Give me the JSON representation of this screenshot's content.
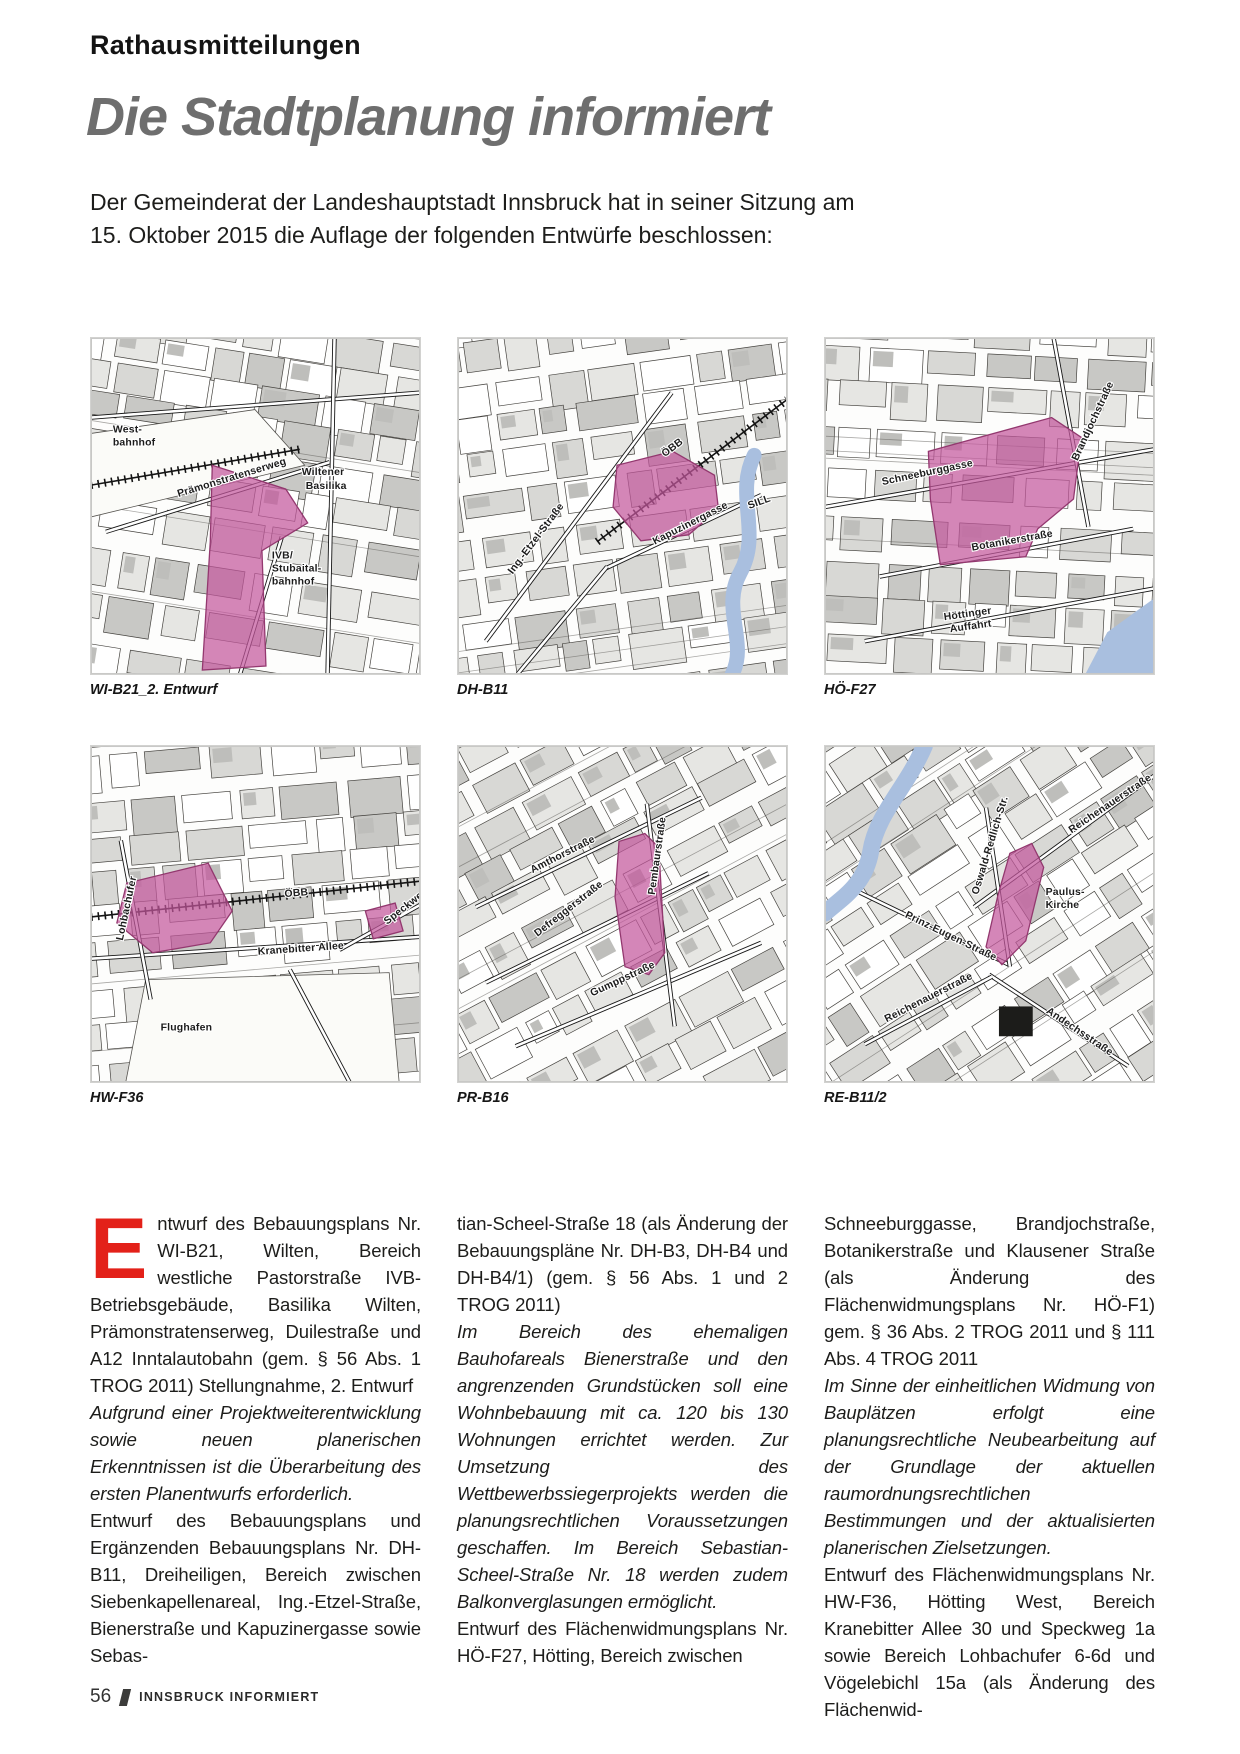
{
  "header": {
    "kicker": "Rathausmitteilungen",
    "title": "Die Stadtplanung informiert",
    "intro": [
      "Der Gemeinderat der Landeshauptstadt Innsbruck hat in seiner Sitzung am",
      "15. Oktober 2015 die Auflage der folgenden Entwürfe beschlossen:"
    ]
  },
  "colors": {
    "accent_red": "#e32119",
    "title_gray": "#6e6e6e",
    "highlight_pink": "#c4589d",
    "highlight_stroke": "#93386f",
    "river_blue": "#a9bfdf",
    "building_grays": [
      "#ffffff",
      "#e6e6e3",
      "#d8d8d5",
      "#c8c8c5"
    ]
  },
  "maps": [
    {
      "caption": "WI-B21_2. Entwurf",
      "seed": 11,
      "grid_angle": 9,
      "roads": [
        [
          15,
          195,
          240,
          125
        ],
        [
          0,
          80,
          331,
          55
        ],
        [
          245,
          0,
          238,
          338
        ],
        [
          150,
          338,
          192,
          200
        ]
      ],
      "rails": [
        [
          0,
          148,
          210,
          112
        ]
      ],
      "open": [
        [
          "0,96 165,72 215,128 0,180"
        ]
      ],
      "river": null,
      "highlights": [
        "122,128 196,152 218,186 172,214 176,330 112,334 120,205"
      ],
      "darks": [],
      "labels": [
        {
          "t": "West-",
          "x": 22,
          "y": 95,
          "r": 0
        },
        {
          "t": "bahnhof",
          "x": 22,
          "y": 108,
          "r": 0
        },
        {
          "t": "Prämonstratenserweg",
          "x": 88,
          "y": 160,
          "r": -17
        },
        {
          "t": "Wiltener",
          "x": 212,
          "y": 138,
          "r": 0
        },
        {
          "t": "Basilika",
          "x": 216,
          "y": 152,
          "r": 0
        },
        {
          "t": "IVB/",
          "x": 182,
          "y": 222,
          "r": 0
        },
        {
          "t": "Stubaital-",
          "x": 182,
          "y": 235,
          "r": 0
        },
        {
          "t": "bahnhof",
          "x": 182,
          "y": 248,
          "r": 0
        }
      ]
    },
    {
      "caption": "DH-B11",
      "seed": 22,
      "grid_angle": -8,
      "roads": [
        [
          28,
          305,
          215,
          55
        ],
        [
          148,
          232,
          305,
          158
        ],
        [
          60,
          338,
          150,
          230
        ]
      ],
      "rails": [
        [
          140,
          205,
          331,
          62
        ]
      ],
      "open": [],
      "river": {
        "d": "M 298,118 C 278,158 306,196 284,236 C 264,272 292,306 276,338",
        "w": 15
      },
      "highlights": [
        "160,128 216,114 258,138 262,172 232,198 184,204 156,170"
      ],
      "darks": [],
      "labels": [
        {
          "t": "Ing.-Etzel-Straße",
          "x": 55,
          "y": 238,
          "r": -53
        },
        {
          "t": "ÖBB",
          "x": 208,
          "y": 120,
          "r": -37
        },
        {
          "t": "Kapuzinergasse",
          "x": 198,
          "y": 208,
          "r": -27
        },
        {
          "t": "SILL",
          "x": 293,
          "y": 172,
          "r": -20
        }
      ]
    },
    {
      "caption": "HÖ-F27",
      "seed": 33,
      "grid_angle": 3,
      "roads": [
        [
          0,
          170,
          331,
          112
        ],
        [
          55,
          240,
          310,
          192
        ],
        [
          40,
          305,
          331,
          252
        ],
        [
          230,
          0,
          265,
          190
        ]
      ],
      "rails": [],
      "open": [],
      "river": {
        "points": "284,296 331,262 331,338 262,338"
      },
      "highlights": [
        "104,114 228,80 258,100 250,162 214,192 202,220 116,228 106,162"
      ],
      "darks": [],
      "labels": [
        {
          "t": "Schneeburggasse",
          "x": 58,
          "y": 148,
          "r": -12
        },
        {
          "t": "Brandjochstraße",
          "x": 254,
          "y": 124,
          "r": -65
        },
        {
          "t": "Botanikerstraße",
          "x": 148,
          "y": 214,
          "r": -10
        },
        {
          "t": "Höttinger",
          "x": 120,
          "y": 284,
          "r": -8
        },
        {
          "t": "Auffahrt",
          "x": 126,
          "y": 296,
          "r": -8
        }
      ]
    },
    {
      "caption": "HW-F36",
      "seed": 44,
      "grid_angle": -5,
      "roads": [
        [
          0,
          214,
          331,
          192
        ],
        [
          30,
          95,
          60,
          255
        ],
        [
          250,
          205,
          331,
          160
        ],
        [
          200,
          225,
          260,
          338
        ]
      ],
      "rails": [
        [
          0,
          172,
          331,
          136
        ]
      ],
      "open": [
        [
          "55,235 300,228 310,338 35,338"
        ]
      ],
      "river": null,
      "highlights": [
        "36,138 118,118 142,166 120,198 62,208 26,178",
        "276,166 306,158 314,186 284,194"
      ],
      "darks": [],
      "labels": [
        {
          "t": "ÖBB",
          "x": 195,
          "y": 152,
          "r": -5
        },
        {
          "t": "Kranebitter Allee",
          "x": 168,
          "y": 210,
          "r": -4
        },
        {
          "t": "Flughafen",
          "x": 70,
          "y": 286,
          "r": 0
        },
        {
          "t": "Lohbachufer",
          "x": 32,
          "y": 196,
          "r": -78
        },
        {
          "t": "Speckweg",
          "x": 298,
          "y": 180,
          "r": -38
        }
      ]
    },
    {
      "caption": "PR-B16",
      "seed": 55,
      "grid_angle": -28,
      "roads": [
        [
          18,
          162,
          245,
          52
        ],
        [
          28,
          238,
          252,
          128
        ],
        [
          58,
          302,
          305,
          198
        ],
        [
          190,
          58,
          218,
          282
        ]
      ],
      "rails": [],
      "open": [],
      "river": null,
      "highlights": [
        "162,96 188,88 202,102 208,208 192,230 168,222 158,152"
      ],
      "darks": [],
      "labels": [
        {
          "t": "Amthorstraße",
          "x": 75,
          "y": 128,
          "r": -27
        },
        {
          "t": "Defreggerstraße",
          "x": 80,
          "y": 192,
          "r": -38
        },
        {
          "t": "Gumppstraße",
          "x": 135,
          "y": 252,
          "r": -25
        },
        {
          "t": "Pembaurstraße",
          "x": 198,
          "y": 150,
          "r": -82
        }
      ]
    },
    {
      "caption": "RE-B11/2",
      "seed": 66,
      "grid_angle": -33,
      "roads": [
        [
          150,
          162,
          331,
          30
        ],
        [
          30,
          145,
          185,
          220
        ],
        [
          165,
          230,
          305,
          322
        ],
        [
          162,
          62,
          186,
          222
        ],
        [
          40,
          300,
          168,
          232
        ]
      ],
      "rails": [],
      "open": [],
      "river": {
        "d": "M 100,0 C 82,42 52,68 46,106 C 40,140 18,152 0,168",
        "w": 17
      },
      "highlights": [
        "186,108 208,98 220,122 202,196 178,220 162,202 174,150"
      ],
      "darks": [
        [
          175,
          262,
          34,
          30
        ]
      ],
      "labels": [
        {
          "t": "Reichenauerstraße",
          "x": 248,
          "y": 88,
          "r": -34
        },
        {
          "t": "Paulus-",
          "x": 222,
          "y": 150,
          "r": 0
        },
        {
          "t": "Kirche",
          "x": 222,
          "y": 163,
          "r": 0
        },
        {
          "t": "Prinz-Eugen-Straße",
          "x": 80,
          "y": 172,
          "r": 26
        },
        {
          "t": "Oswald-Redlich-Str.",
          "x": 154,
          "y": 150,
          "r": -73
        },
        {
          "t": "Andechsstraße",
          "x": 222,
          "y": 268,
          "r": 34
        },
        {
          "t": "Reichenauerstraße",
          "x": 62,
          "y": 278,
          "r": -27
        }
      ]
    }
  ],
  "columns": [
    {
      "paragraphs": [
        {
          "style": "normal",
          "drop_cap": "E",
          "text": "ntwurf des Bebauungsplans Nr. WI-B21, Wilten, Bereich westliche Pastorstraße IVB-Betriebsgebäude, Basilika Wilten, Prämonstratenserweg, Duilestraße und A12 Inntalautobahn (gem. § 56 Abs. 1 TROG 2011) Stellungnahme, 2. Entwurf"
        },
        {
          "style": "italic",
          "text": "Aufgrund einer Projektweiterentwicklung sowie neuen planerischen Erkenntnissen ist die Überarbeitung des ersten Planentwurfs erforderlich."
        },
        {
          "style": "normal",
          "text": "Entwurf des Bebauungsplans und Ergänzenden Bebauungsplans Nr. DH-B11, Dreiheiligen, Bereich zwischen Siebenkapellenareal, Ing.-Etzel-Straße, Bienerstraße und Kapuzinergasse sowie Sebas-"
        }
      ]
    },
    {
      "paragraphs": [
        {
          "style": "normal",
          "text": "tian-Scheel-Straße 18 (als Änderung der Bebauungspläne Nr. DH-B3, DH-B4 und DH-B4/1) (gem. § 56 Abs. 1 und 2 TROG 2011)"
        },
        {
          "style": "italic",
          "text": "Im Bereich des ehemaligen Bauhofareals Bienerstraße und den angrenzenden Grundstücken soll eine Wohnbebauung mit ca. 120 bis 130 Wohnungen errichtet werden. Zur Umsetzung des Wettbewerbssiegerprojekts werden die planungsrechtlichen Voraussetzungen geschaffen. Im Bereich Sebastian-Scheel-Straße Nr. 18 werden zudem Balkonverglasungen ermöglicht."
        },
        {
          "style": "normal",
          "text": "Entwurf des Flächenwidmungsplans Nr. HÖ-F27, Hötting, Bereich zwischen"
        }
      ]
    },
    {
      "paragraphs": [
        {
          "style": "normal",
          "text": "Schneeburggasse, Brandjochstraße, Botanikerstraße und Klausener Straße (als Änderung des Flächenwidmungsplans Nr. HÖ-F1) gem. § 36 Abs. 2 TROG 2011 und § 111 Abs. 4 TROG 2011"
        },
        {
          "style": "italic",
          "text": "Im Sinne der einheitlichen Widmung von Bauplätzen erfolgt eine planungsrechtliche Neubearbeitung auf der Grundlage der aktuellen raumordnungsrechtlichen Bestimmungen und der aktualisierten planerischen Zielsetzungen."
        },
        {
          "style": "normal",
          "text": "Entwurf des Flächenwidmungsplans Nr. HW-F36, Hötting West, Bereich Kranebitter Allee 30 und Speckweg 1a sowie Bereich Lohbachufer 6-6d und Vögelebichl 15a (als Änderung des Flächenwid-"
        }
      ]
    }
  ],
  "footer": {
    "page_number": "56",
    "magazine": "INNSBRUCK INFORMIERT"
  }
}
